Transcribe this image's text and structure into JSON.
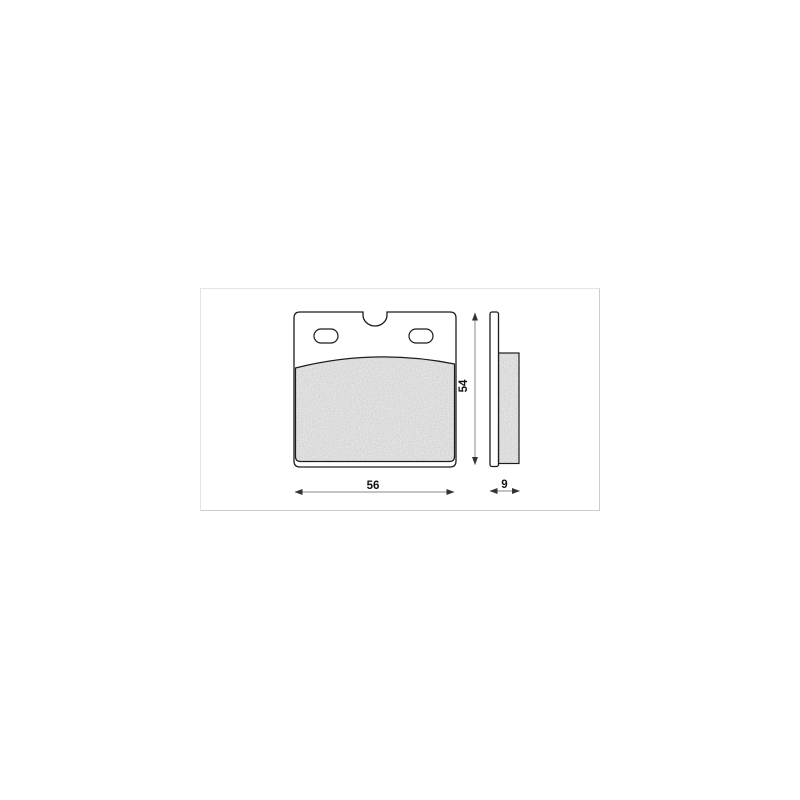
{
  "drawing": {
    "subject": "brake-pad-technical-drawing",
    "dimensions": {
      "width": "56",
      "height": "54",
      "thickness": "9"
    },
    "colors": {
      "outline": "#1c1c1c",
      "dimension_line": "#8a8a8a",
      "dimension_text": "#111111",
      "friction_fill": "#c2c2c2",
      "plate_fill": "#ffffff",
      "canvas_border": "#cccccc",
      "page_background": "#ffffff"
    }
  }
}
